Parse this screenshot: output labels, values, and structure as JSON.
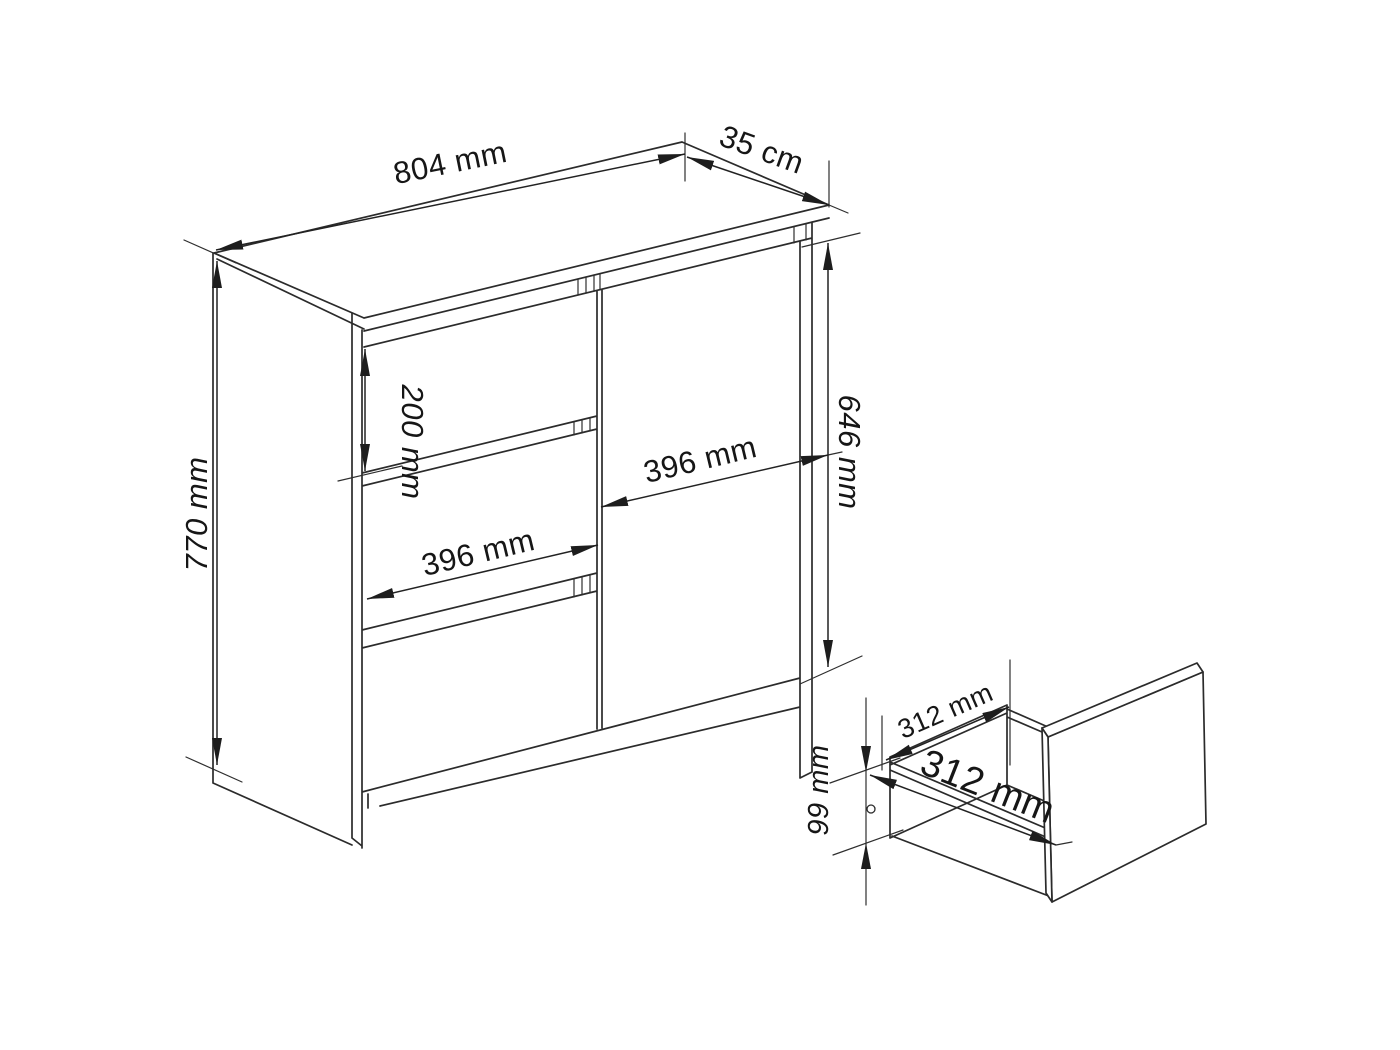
{
  "figure": {
    "type": "furniture-technical-drawing",
    "subject": "chest of drawers with door and pull-out drawer detail",
    "line_color": "#2b2b2b",
    "background_color": "#ffffff",
    "main_view": {
      "top_width_label": "804 mm",
      "top_depth_label": "35 cm",
      "total_height_label": "770 mm",
      "drawer_height_label": "200 mm",
      "drawer_width_label": "396 mm",
      "door_width_label": "396 mm",
      "door_height_label": "646 mm"
    },
    "drawer_detail_view": {
      "inner_width_label": "312 mm",
      "inner_depth_label": "312 mm",
      "side_height_label": "99 mm"
    }
  }
}
